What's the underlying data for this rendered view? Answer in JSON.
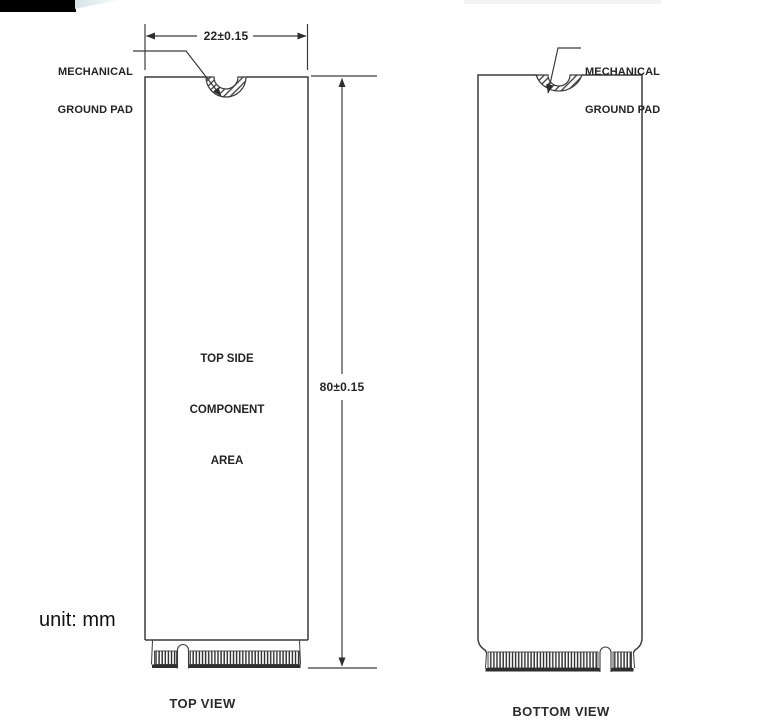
{
  "page": {
    "unit_label": "unit: mm"
  },
  "top_view": {
    "caption": "TOP VIEW",
    "width_dim_label": "22±0.15",
    "height_dim_label": "80±0.15",
    "ground_pad_label": {
      "line1": "MECHANICAL",
      "line2": "GROUND PAD"
    },
    "component_area": {
      "line1": "TOP SIDE",
      "line2": "COMPONENT",
      "line3": "AREA"
    }
  },
  "bottom_view": {
    "caption": "BOTTOM VIEW",
    "ground_pad_label": {
      "line1": "MECHANICAL",
      "line2": "GROUND PAD"
    }
  },
  "colors": {
    "line": "#3c3c3c",
    "text": "#1c1c1c",
    "logo_black": "#000000",
    "logo_swoosh": "#d9e7e9",
    "header_bar": "#f3f3f3"
  }
}
